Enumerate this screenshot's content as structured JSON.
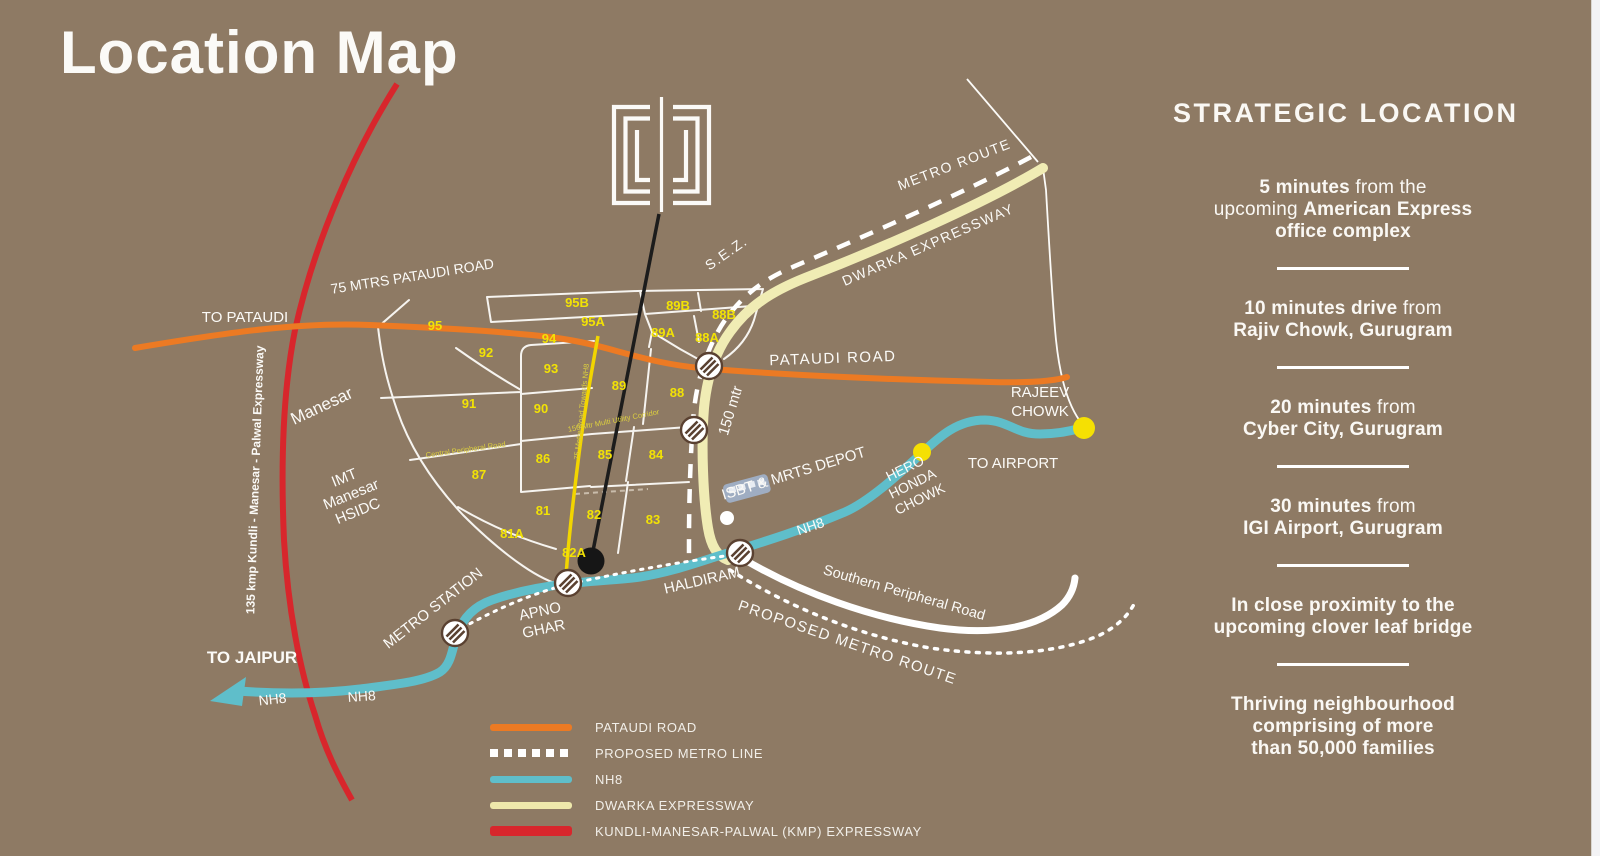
{
  "title": "Location Map",
  "colors": {
    "background": "#8e7a64",
    "pataudi_road": "#ec7a23",
    "nh8": "#5fbeca",
    "dwarka_expressway": "#f0ecb4",
    "kmp_expressway": "#d8262c",
    "local_yellow_road": "#f2d500",
    "sector_label": "#f2e205",
    "marker": "#1c1c1c",
    "highlight_dot": "#f5e003"
  },
  "strategic": {
    "heading": "STRATEGIC LOCATION",
    "items": [
      {
        "segments": [
          {
            "text": "5 minutes",
            "bold": true
          },
          {
            "text": " from the",
            "bold": false
          },
          {
            "br": true
          },
          {
            "text": "upcoming ",
            "bold": false
          },
          {
            "text": "American Express",
            "bold": true
          },
          {
            "br": true
          },
          {
            "text": "office complex",
            "bold": true
          }
        ]
      },
      {
        "segments": [
          {
            "text": "10 minutes drive",
            "bold": true
          },
          {
            "text": " from",
            "bold": false
          },
          {
            "br": true
          },
          {
            "text": "Rajiv Chowk, Gurugram",
            "bold": true
          }
        ]
      },
      {
        "segments": [
          {
            "text": "20 minutes",
            "bold": true
          },
          {
            "text": " from",
            "bold": false
          },
          {
            "br": true
          },
          {
            "text": "Cyber City, Gurugram",
            "bold": true
          }
        ]
      },
      {
        "segments": [
          {
            "text": "30 minutes",
            "bold": true
          },
          {
            "text": " from",
            "bold": false
          },
          {
            "br": true
          },
          {
            "text": "IGI Airport, Gurugram",
            "bold": true
          }
        ]
      },
      {
        "segments": [
          {
            "text": "In close proximity to the",
            "bold": true
          },
          {
            "br": true
          },
          {
            "text": "upcoming clover leaf bridge",
            "bold": true
          }
        ]
      },
      {
        "segments": [
          {
            "text": "Thriving neighbourhood",
            "bold": true
          },
          {
            "br": true
          },
          {
            "text": "comprising of more",
            "bold": true
          },
          {
            "br": true
          },
          {
            "text": "than 50,000 families",
            "bold": true
          }
        ]
      }
    ]
  },
  "legend": {
    "items": [
      {
        "label": "PATAUDI ROAD",
        "style": "solid",
        "color": "#ec7a23"
      },
      {
        "label": "PROPOSED METRO LINE",
        "style": "dotted",
        "color": "#ffffff"
      },
      {
        "label": "NH8",
        "style": "solid",
        "color": "#5fbeca"
      },
      {
        "label": "DWARKA EXPRESSWAY",
        "style": "solid",
        "color": "#eee8ab"
      },
      {
        "label": "KUNDLI-MANESAR-PALWAL (KMP) EXPRESSWAY",
        "style": "solid red",
        "color": "#d8262c"
      }
    ]
  },
  "map": {
    "sectors": [
      {
        "id": "95",
        "x": 435,
        "y": 330
      },
      {
        "id": "95B",
        "x": 577,
        "y": 307
      },
      {
        "id": "95A",
        "x": 593,
        "y": 326
      },
      {
        "id": "94",
        "x": 549,
        "y": 343
      },
      {
        "id": "92",
        "x": 486,
        "y": 357
      },
      {
        "id": "93",
        "x": 551,
        "y": 373
      },
      {
        "id": "89B",
        "x": 678,
        "y": 310
      },
      {
        "id": "88B",
        "x": 724,
        "y": 319
      },
      {
        "id": "89A",
        "x": 663,
        "y": 337
      },
      {
        "id": "88A",
        "x": 707,
        "y": 342
      },
      {
        "id": "89",
        "x": 619,
        "y": 390
      },
      {
        "id": "88",
        "x": 677,
        "y": 397
      },
      {
        "id": "91",
        "x": 469,
        "y": 408
      },
      {
        "id": "90",
        "x": 541,
        "y": 413
      },
      {
        "id": "87",
        "x": 479,
        "y": 479
      },
      {
        "id": "86",
        "x": 543,
        "y": 463
      },
      {
        "id": "85",
        "x": 605,
        "y": 459
      },
      {
        "id": "84",
        "x": 656,
        "y": 459
      },
      {
        "id": "81",
        "x": 543,
        "y": 515
      },
      {
        "id": "82",
        "x": 594,
        "y": 519
      },
      {
        "id": "83",
        "x": 653,
        "y": 524
      },
      {
        "id": "81A",
        "x": 512,
        "y": 538
      },
      {
        "id": "82A",
        "x": 574,
        "y": 557
      }
    ],
    "metro_stations": [
      {
        "x": 709,
        "y": 366
      },
      {
        "x": 694,
        "y": 430
      },
      {
        "x": 740,
        "y": 553
      },
      {
        "x": 568,
        "y": 583
      },
      {
        "x": 455,
        "y": 633
      }
    ],
    "labels": {
      "to_pataudi": "TO PATAUDI",
      "pataudi_75": "75 MTRS PATAUDI ROAD",
      "pataudi_road": "PATAUDI ROAD",
      "kmp": "135 kmp Kundli - Manesar - Palwal Expressway",
      "manesar": "Manesar",
      "imt": [
        "IMT",
        "Manesar",
        "HSIDC"
      ],
      "sez": "S.E.Z.",
      "metro_route": "METRO ROUTE",
      "dwarka": "DWARKA EXPRESSWAY",
      "mtr150": "150 mtr",
      "rajeev": [
        "RAJEEV",
        "CHOWK"
      ],
      "to_airport": "TO AIRPORT",
      "hero": [
        "HERO",
        "HONDA",
        "CHOWK"
      ],
      "isbt": "ISBT & MRTS DEPOT",
      "haldiram": "HALDIRAM",
      "spr": "Southern Peripheral Road",
      "pmr": "PROPOSED METRO ROUTE",
      "metro_station": "METRO STATION",
      "apno": [
        "APNO",
        "GHAR"
      ],
      "to_jaipur": "TO JAIPUR",
      "nh8_a": "NH8",
      "nh8_b": "NH8",
      "nh8_c": "NH8",
      "central_peripheral": "Central Peripheral Road",
      "road75": "75 Metre Road Towards NH8",
      "corridor": "150 Mtr Multi Utility Corridor"
    }
  }
}
